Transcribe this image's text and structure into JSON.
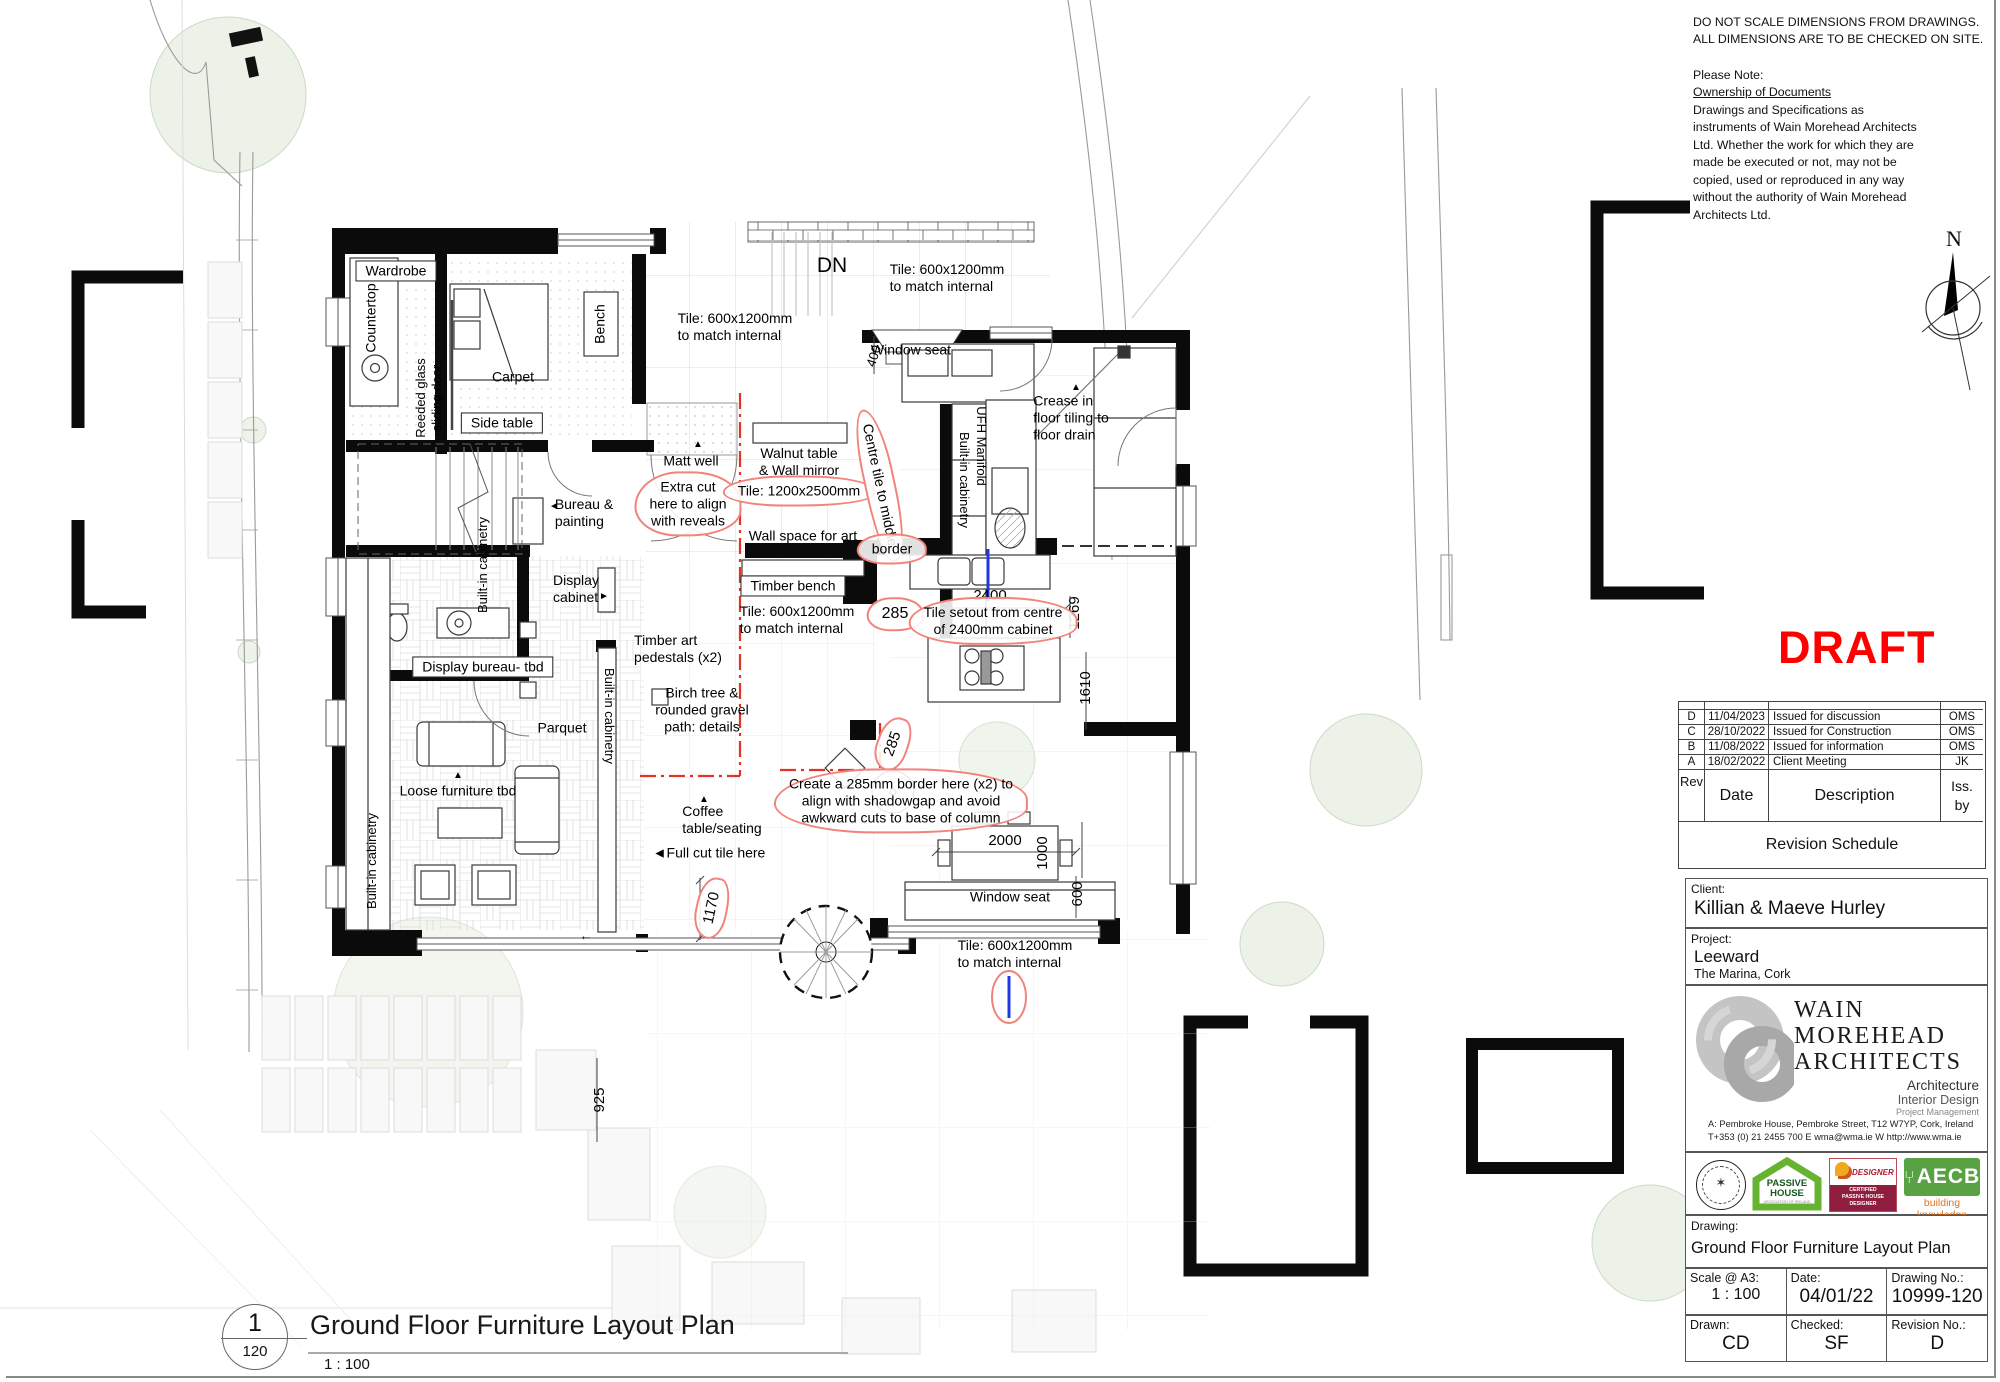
{
  "colors": {
    "draft": "#ff0000",
    "markup_red": "#e23325",
    "markup_blue": "#2337e0",
    "cloud_red": "#f2837a"
  },
  "disclaimer": {
    "line1": "DO NOT SCALE DIMENSIONS FROM DRAWINGS.",
    "line2": "ALL DIMENSIONS ARE TO BE CHECKED ON SITE.",
    "note_label": "Please Note:",
    "ownership_heading": "Ownership of Documents",
    "body": "Drawings and Specifications  as instruments of Wain Morehead Architects Ltd. Whether the work for which they are made be executed or not, may not be copied, used or reproduced in any way without the authority of Wain Morehead Architects Ltd."
  },
  "compass": {
    "north_label": "N"
  },
  "draft": {
    "text": "DRAFT"
  },
  "title_block": {
    "revision_schedule": {
      "title": "Revision Schedule",
      "columns": {
        "rev": "Rev",
        "date": "Date",
        "description": "Description",
        "issued_by": "Iss.\nby"
      },
      "rows": [
        {
          "rev": "D",
          "date": "11/04/2023",
          "description": "Issued for discussion",
          "by": "OMS"
        },
        {
          "rev": "C",
          "date": "28/10/2022",
          "description": "Issued for Construction",
          "by": "OMS"
        },
        {
          "rev": "B",
          "date": "11/08/2022",
          "description": "Issued for information",
          "by": "OMS"
        },
        {
          "rev": "A",
          "date": "18/02/2022",
          "description": "Client Meeting",
          "by": "JK"
        }
      ]
    },
    "client": {
      "label": "Client:",
      "name": "Killian & Maeve Hurley"
    },
    "project": {
      "label": "Project:",
      "name": "Leeward",
      "location": "The Marina, Cork"
    },
    "architect": {
      "name_line1": "WAIN",
      "name_line2": "MOREHEAD",
      "name_line3": "ARCHITECTS",
      "service1": "Architecture",
      "service2": "Interior Design",
      "service3": "Project Management",
      "address_line": "A: Pembroke House, Pembroke Street, T12 W7YP, Cork, Ireland",
      "contact_line": "T+353 (0) 21 2455 700  E wma@wma.ie  W http://www.wma.ie"
    },
    "certifications": {
      "passive_house": {
        "line1": "PASSIVE",
        "line2": "HOUSE",
        "sub": "ASSOCIATION OF IRELAND"
      },
      "designer": {
        "title": "DESIGNER",
        "sub": "CERTIFIED\nPASSIVE HOUSE\nDESIGNER"
      },
      "aecb": {
        "title": "AECB",
        "tagline": "building knowledge"
      }
    },
    "drawing_info": {
      "drawing_label": "Drawing:",
      "title": "Ground Floor Furniture Layout Plan",
      "scale_label": "Scale @ A3:",
      "scale": "1 : 100",
      "date_label": "Date:",
      "date": "04/01/22",
      "number_label": "Drawing No.:",
      "number": "10999-120",
      "drawn_label": "Drawn:",
      "drawn": "CD",
      "checked_label": "Checked:",
      "checked": "SF",
      "revision_label": "Revision No.:",
      "revision": "D"
    }
  },
  "plan": {
    "title": {
      "number": "1",
      "detail": "120",
      "title": "Ground Floor Furniture Layout Plan",
      "scale": "1 : 100"
    },
    "annotations": [
      {
        "t": "DN",
        "x": 832,
        "y": 266,
        "s": 21
      },
      {
        "t": "Tile: 600x1200mm\nto match internal",
        "x": 947,
        "y": 278,
        "al": "left"
      },
      {
        "t": "Tile: 600x1200mm\nto match internal",
        "x": 735,
        "y": 327,
        "al": "left"
      },
      {
        "t": "Window seat",
        "x": 911,
        "y": 350
      },
      {
        "t": "400",
        "x": 874,
        "y": 356,
        "r": -72,
        "s": 13
      },
      {
        "t": "Crease in\nfloor tiling to\nfloor drain",
        "x": 1071,
        "y": 418,
        "al": "left"
      },
      {
        "t": "▲",
        "x": 1076,
        "y": 388,
        "s": 10
      },
      {
        "t": "Matt well",
        "x": 691,
        "y": 461
      },
      {
        "t": "▲",
        "x": 698,
        "y": 445,
        "s": 10
      },
      {
        "t": "Walnut table\n& Wall mirror",
        "x": 799,
        "y": 462
      },
      {
        "t": "Wall space for art",
        "x": 803,
        "y": 536
      },
      {
        "t": "Bureau &\npainting",
        "x": 584,
        "y": 513,
        "al": "left"
      },
      {
        "t": "◄",
        "x": 554,
        "y": 507,
        "s": 10
      },
      {
        "t": "Display\ncabinet",
        "x": 576,
        "y": 589,
        "al": "left"
      },
      {
        "t": "►",
        "x": 604,
        "y": 597,
        "s": 10
      },
      {
        "t": "Timber art\npedestals (x2)",
        "x": 678,
        "y": 649,
        "al": "left"
      },
      {
        "t": "Birch tree &\nrounded gravel\npath: details",
        "x": 702,
        "y": 710
      },
      {
        "t": "Parquet",
        "x": 562,
        "y": 728
      },
      {
        "t": "Loose furniture tbd",
        "x": 458,
        "y": 791
      },
      {
        "t": "▲",
        "x": 458,
        "y": 776,
        "s": 10
      },
      {
        "t": "Coffee\ntable/seating",
        "x": 722,
        "y": 820,
        "al": "left"
      },
      {
        "t": "▲",
        "x": 704,
        "y": 800,
        "s": 10
      },
      {
        "t": "◄Full cut tile here",
        "x": 709,
        "y": 853
      },
      {
        "t": "Carpet",
        "x": 513,
        "y": 377
      },
      {
        "t": "Tile: 600x1200mm\nto match internal",
        "x": 797,
        "y": 620,
        "al": "left"
      },
      {
        "t": "Window seat",
        "x": 1010,
        "y": 897
      },
      {
        "t": "Tile: 600x1200mm\nto match internal",
        "x": 1015,
        "y": 954,
        "al": "left"
      },
      {
        "t": "2400",
        "x": 990,
        "y": 596,
        "s": 15
      },
      {
        "t": "1269",
        "x": 1075,
        "y": 613,
        "r": -90,
        "s": 15
      },
      {
        "t": "1610",
        "x": 1086,
        "y": 688,
        "r": -90,
        "s": 15
      },
      {
        "t": "2000",
        "x": 1005,
        "y": 841,
        "s": 15
      },
      {
        "t": "1000",
        "x": 1043,
        "y": 853,
        "r": -90,
        "s": 15
      },
      {
        "t": "600",
        "x": 1078,
        "y": 894,
        "r": -90,
        "s": 15
      },
      {
        "t": "925",
        "x": 600,
        "y": 1100,
        "r": -90,
        "s": 15
      },
      {
        "t": "285",
        "x": 895,
        "y": 614,
        "k": "cloud",
        "s": 16
      },
      {
        "t": "285",
        "x": 893,
        "y": 744,
        "r": -70,
        "k": "cloud",
        "s": 15
      },
      {
        "t": "1170",
        "x": 712,
        "y": 908,
        "r": -78,
        "k": "cloud",
        "s": 15
      },
      {
        "t": "Extra cut\nhere to align\nwith reveals",
        "x": 688,
        "y": 504,
        "k": "cloud"
      },
      {
        "t": "Tile: 1200x2500mm",
        "x": 799,
        "y": 491,
        "k": "cloud"
      },
      {
        "t": "Centre tile to middle",
        "x": 880,
        "y": 485,
        "r": 78,
        "k": "cloud"
      },
      {
        "t": "border",
        "x": 892,
        "y": 549,
        "k": "cloud"
      },
      {
        "t": "Tile setout from centre\nof 2400mm cabinet",
        "x": 993,
        "y": 621,
        "k": "cloud"
      },
      {
        "t": "Create a 285mm border here (x2) to\nalign with shadowgap and avoid\nawkward cuts to base of column",
        "x": 901,
        "y": 801,
        "k": "cloud"
      },
      {
        "t": "Wardrobe",
        "x": 396,
        "y": 271,
        "k": "box"
      },
      {
        "t": "Side table",
        "x": 502,
        "y": 423,
        "k": "box"
      },
      {
        "t": "Timber bench",
        "x": 793,
        "y": 586,
        "k": "box"
      },
      {
        "t": "Display bureau- tbd",
        "x": 483,
        "y": 667,
        "k": "box"
      },
      {
        "t": "Countertop",
        "x": 371,
        "y": 318,
        "r": -90
      },
      {
        "t": "Bench",
        "x": 600,
        "y": 324,
        "r": -90
      },
      {
        "t": "Reeded glass\nsliding door",
        "x": 429,
        "y": 398,
        "r": -90,
        "s": 13
      },
      {
        "t": "UFH Manifold",
        "x": 981,
        "y": 446,
        "r": 90,
        "s": 13
      },
      {
        "t": "Built-in cabinetry",
        "x": 964,
        "y": 480,
        "r": 90,
        "s": 13
      },
      {
        "t": "Built-in cabinetry",
        "x": 483,
        "y": 565,
        "r": -90,
        "s": 13
      },
      {
        "t": "Built-in cabinetry",
        "x": 609,
        "y": 716,
        "r": 90,
        "s": 13
      },
      {
        "t": "Built-in cabinetry",
        "x": 372,
        "y": 861,
        "r": -90,
        "s": 13
      },
      {
        "t": "←",
        "x": 586,
        "y": 936,
        "s": 13
      }
    ]
  }
}
